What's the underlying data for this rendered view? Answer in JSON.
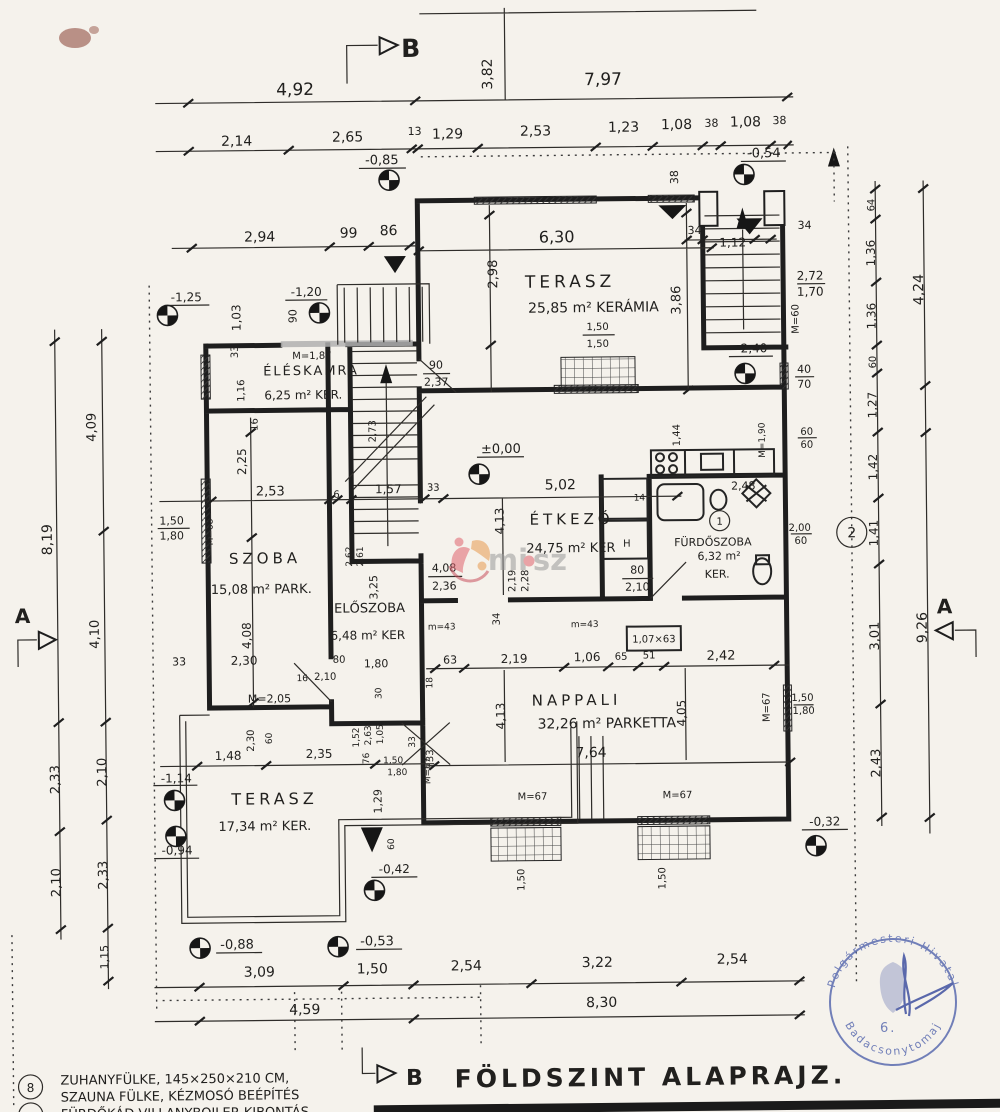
{
  "title": {
    "arrow_letter": "B",
    "text": "FÖLDSZINT ALAPRAJZ."
  },
  "markers": {
    "b_top": "B",
    "a_left": "A",
    "a_right": "A",
    "axis_2": "2"
  },
  "rooms": {
    "terasz_top": {
      "name": "TERASZ",
      "area": "25,85 m² KERÁMIA"
    },
    "eleskamra": {
      "name": "ÉLÉSKAMRA",
      "area": "6,25 m² KER.",
      "lintel": "M=1,87"
    },
    "szoba": {
      "name": "SZOBA",
      "area": "15,08 m² PARK."
    },
    "eloszoba": {
      "name": "ELŐSZOBA",
      "area": "6,48 m² KER"
    },
    "etkezo": {
      "name": "ÉTKEZŐ",
      "area": "24,75 m² KER"
    },
    "furdoszoba": {
      "name": "FÜRDŐSZOBA",
      "area": "6,32 m²",
      "floor": "KER.",
      "fixture_no": "1",
      "tub": "2,48"
    },
    "nappali": {
      "name": "NAPPALI",
      "area": "32,26 m² PARKETTA"
    },
    "terasz_bottom": {
      "name": "TERASZ",
      "area": "17,34 m² KER."
    }
  },
  "levels": {
    "l085": "-0,85",
    "l054": "-0,54",
    "l125": "-1,25",
    "l120": "-1,20",
    "l000": "±0,00",
    "l240": "-2,40",
    "l114": "-1,14",
    "l094": "-0,94",
    "l042": "-0,42",
    "l088": "-0,88",
    "l053": "-0,53",
    "l032": "-0,32"
  },
  "dims": {
    "top1": [
      "4,92",
      "7,97"
    ],
    "v382": "3,82",
    "top2": [
      "2,14",
      "2,65",
      "13",
      "1,29",
      "2,53",
      "1,23",
      "1,08",
      "38",
      "1,08",
      "38"
    ],
    "v38": "38",
    "row3": [
      "2,94",
      "99",
      "86"
    ],
    "w630": "6,30",
    "stair_top": [
      "34",
      "1,12",
      "34"
    ],
    "v298": "2,98",
    "v386": "3,86",
    "terasz_win": [
      "1,50",
      "1,50"
    ],
    "stairR": [
      "2,72",
      "1,70",
      "M=60"
    ],
    "w4070": [
      "40",
      "70"
    ],
    "elesk": [
      "1,03",
      "90",
      "33",
      "1,16",
      "16",
      "2,73"
    ],
    "door9023": [
      "90",
      "2,37"
    ],
    "kitchen": [
      "1,44",
      "M=1,90",
      "60",
      "60",
      "14",
      "H",
      "2,48"
    ],
    "door200": [
      "2,00",
      "60"
    ],
    "midrow": [
      "2,53",
      "16",
      "1,57",
      "33",
      "5,02"
    ],
    "v225": "2,25",
    "v413a": "4,13",
    "szoba_win": [
      "1,50",
      "1,80",
      "M=68"
    ],
    "stairC": [
      "2,62",
      "2,61",
      "3,25"
    ],
    "etk": [
      "4,08",
      "2,36",
      "2,19",
      "2,28",
      "34"
    ],
    "door8021": [
      "80",
      "2,10"
    ],
    "v408": "4,08",
    "szrow": [
      "33",
      "2,30",
      "16",
      "2,10",
      "80",
      "1,80",
      "30",
      "M=2,05"
    ],
    "naptop": [
      "m=43",
      "m=43",
      "1,07×63"
    ],
    "naprow": [
      "63",
      "18",
      "2,19",
      "1,06",
      "65",
      "51",
      "2,42"
    ],
    "v413b": "4,13",
    "v405": "4,05",
    "w764": "7,64",
    "v33": "33",
    "napwin_r": [
      "M=67",
      "1,50",
      "1,80"
    ],
    "napwin_b": [
      "M=67",
      "M=67",
      "1,50",
      "1,50"
    ],
    "left": [
      "8,19",
      "4,09",
      "4,10",
      "2,33",
      "2,10",
      "2,10",
      "2,33",
      "1,15"
    ],
    "right": [
      "64",
      "1,36",
      "1,36",
      "60",
      "1,27",
      "4,24",
      "1,42",
      "1,41",
      "3,01",
      "2,43",
      "9,26"
    ],
    "ter1": [
      "1,48",
      "2,35"
    ],
    "terv": [
      "2,30",
      "60",
      "1,29"
    ],
    "tercl": [
      "1,52",
      "2,63",
      "1,05",
      "76",
      "33",
      "1,50",
      "1,80",
      "M=67",
      "60"
    ],
    "bot1": [
      "3,09",
      "1,50",
      "2,54",
      "3,22",
      "2,54"
    ],
    "bot2": [
      "4,59",
      "8,30"
    ]
  },
  "notes": {
    "n8": "8",
    "line1": "ZUHANYFÜLKE, 145×250×210 CM,",
    "line2": "SZAUNA FÜLKE, KÉZMOSÓ BEÉPÍTÉS",
    "line3": "FÜRDŐKÁD VILLANYBOJLER KIBONTÁS"
  },
  "stamp": {
    "top": "Polgármesteri Hivatal",
    "bottom": "Badacsonytomaj",
    "center": "6."
  },
  "watermark": {
    "left": "mi",
    "right": "sz"
  }
}
